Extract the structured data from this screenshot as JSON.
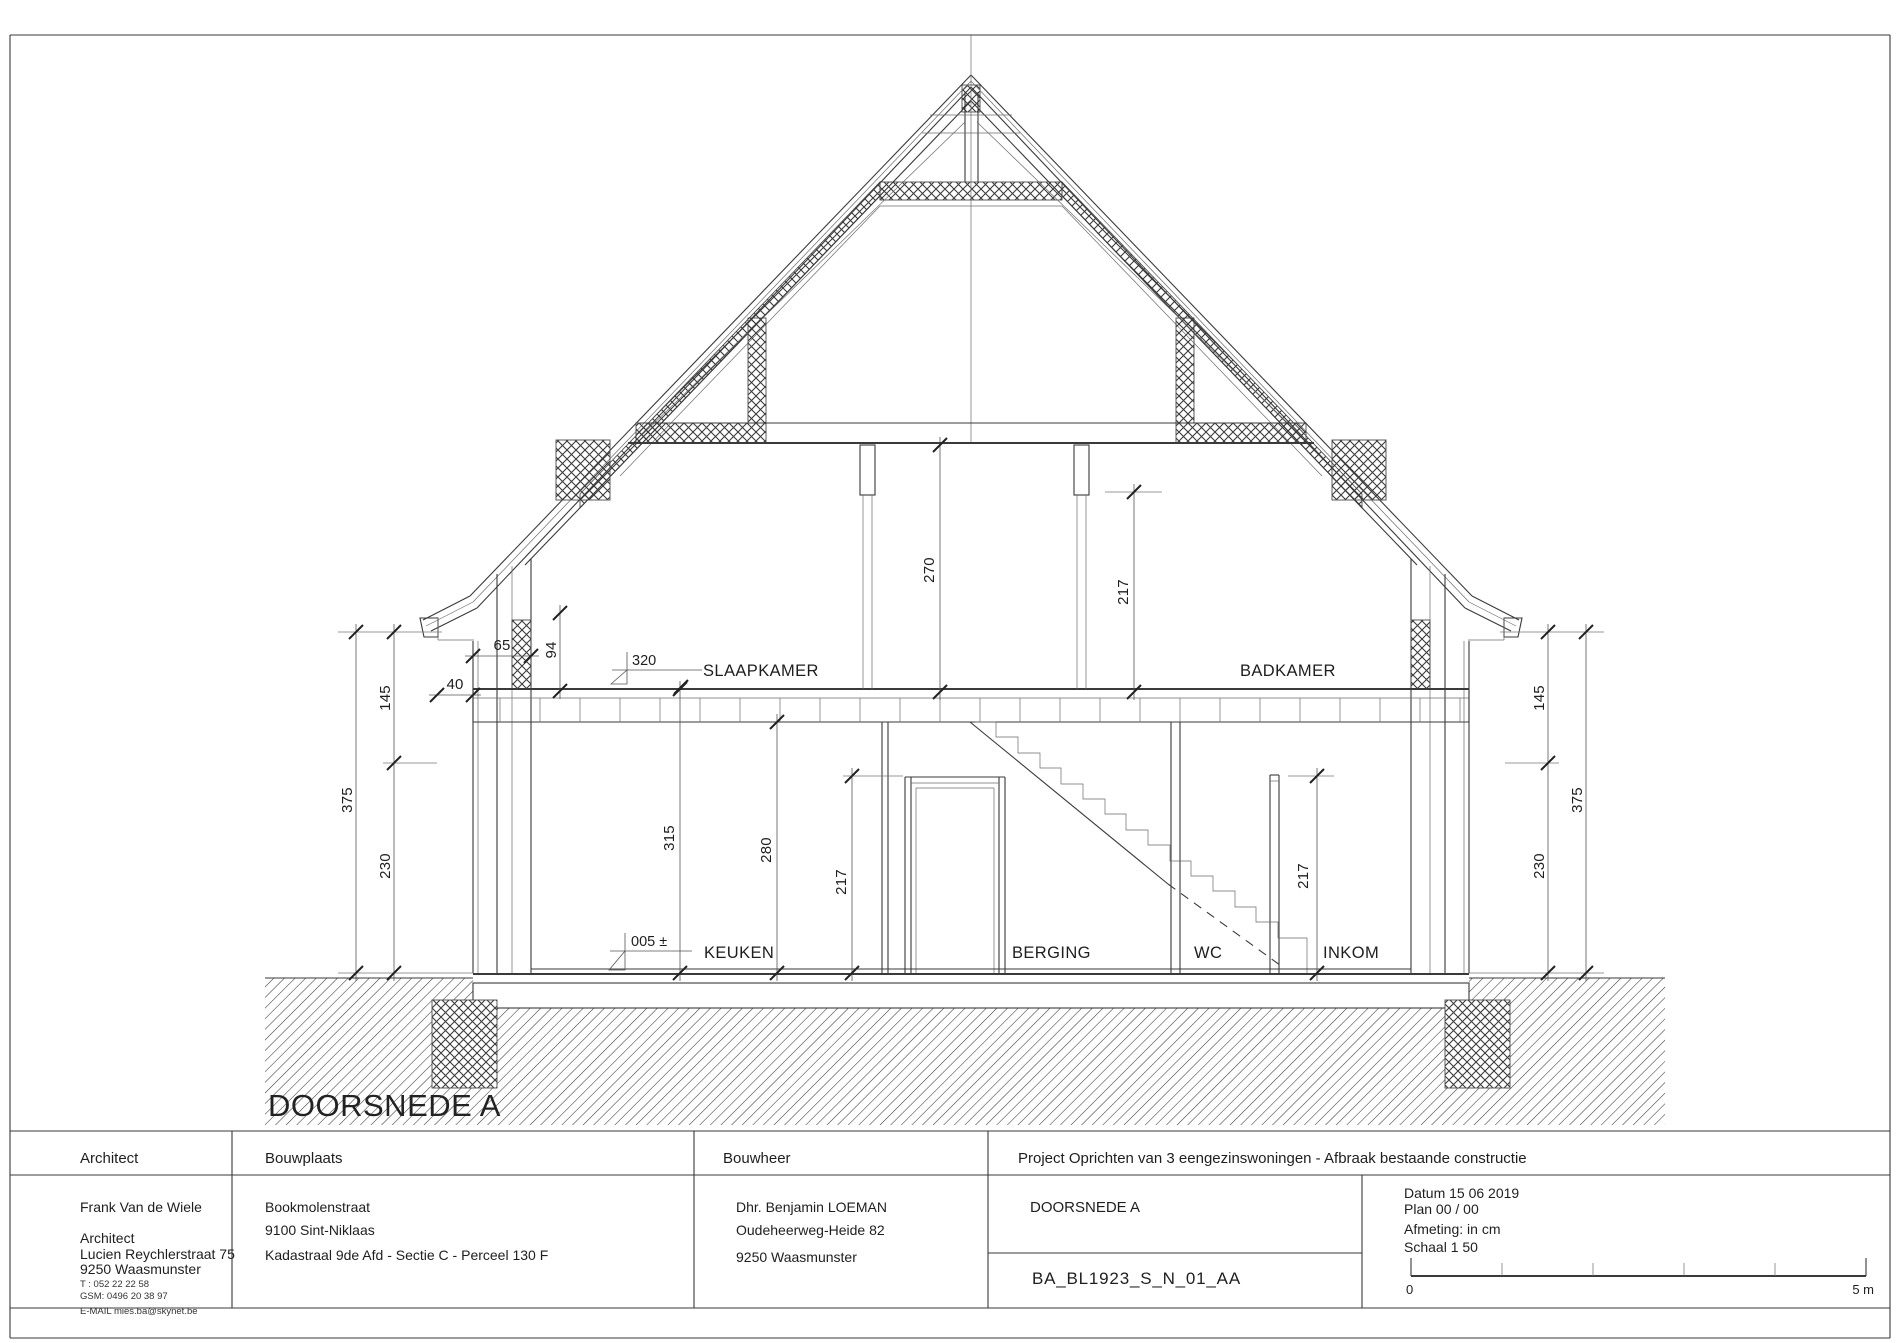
{
  "drawing": {
    "title": "DOORSNEDE A",
    "rooms": {
      "slaapkamer": "SLAAPKAMER",
      "badkamer": "BADKAMER",
      "keuken": "KEUKEN",
      "berging": "BERGING",
      "wc": "WC",
      "inkom": "INKOM"
    },
    "dims": {
      "l375": "375",
      "l145": "145",
      "l230": "230",
      "r375": "375",
      "r145": "145",
      "r230": "230",
      "w65": "65",
      "o40": "40",
      "k94": "94",
      "c270": "270",
      "a217": "217",
      "h315": "315",
      "h280": "280",
      "door217": "217",
      "inkom217": "217",
      "lvl320": "320",
      "lvl005": "005 ±"
    },
    "colors": {
      "background": "#ffffff",
      "line": "#3a3a3a",
      "hatch": "#5a5a5a",
      "text": "#1e1e1e"
    }
  },
  "titleblock": {
    "architect": {
      "header": "Architect",
      "name": "Frank Van de Wiele",
      "role": "Architect",
      "street": "Lucien Reychlerstraat 75",
      "city": "9250  Waasmunster",
      "tel": "T :      052 22 22 58",
      "gsm": "GSM: 0496 20 38 97",
      "email": "E-MAIL  mies.ba@skynet.be"
    },
    "bouwplaats": {
      "header": "Bouwplaats",
      "street": "Bookmolenstraat",
      "city": "9100 Sint-Niklaas",
      "kadaster": "Kadastraal 9de Afd - Sectie C - Perceel 130 F"
    },
    "bouwheer": {
      "header": "Bouwheer",
      "name": "Dhr. Benjamin LOEMAN",
      "street": "Oudeheerweg-Heide 82",
      "city": "9250   Waasmunster"
    },
    "project": {
      "header": "Project  Oprichten van 3 eengezinswoningen - Afbraak bestaande constructie",
      "section": "DOORSNEDE A",
      "code": "BA_BL1923_S_N_01_AA",
      "datum": "Datum 15 06 2019",
      "plan": "Plan 00 / 00",
      "afmeting": "Afmeting:  in cm",
      "schaal": "Schaal  1 50"
    },
    "scalebar": {
      "zero": "0",
      "five": "5 m"
    }
  }
}
